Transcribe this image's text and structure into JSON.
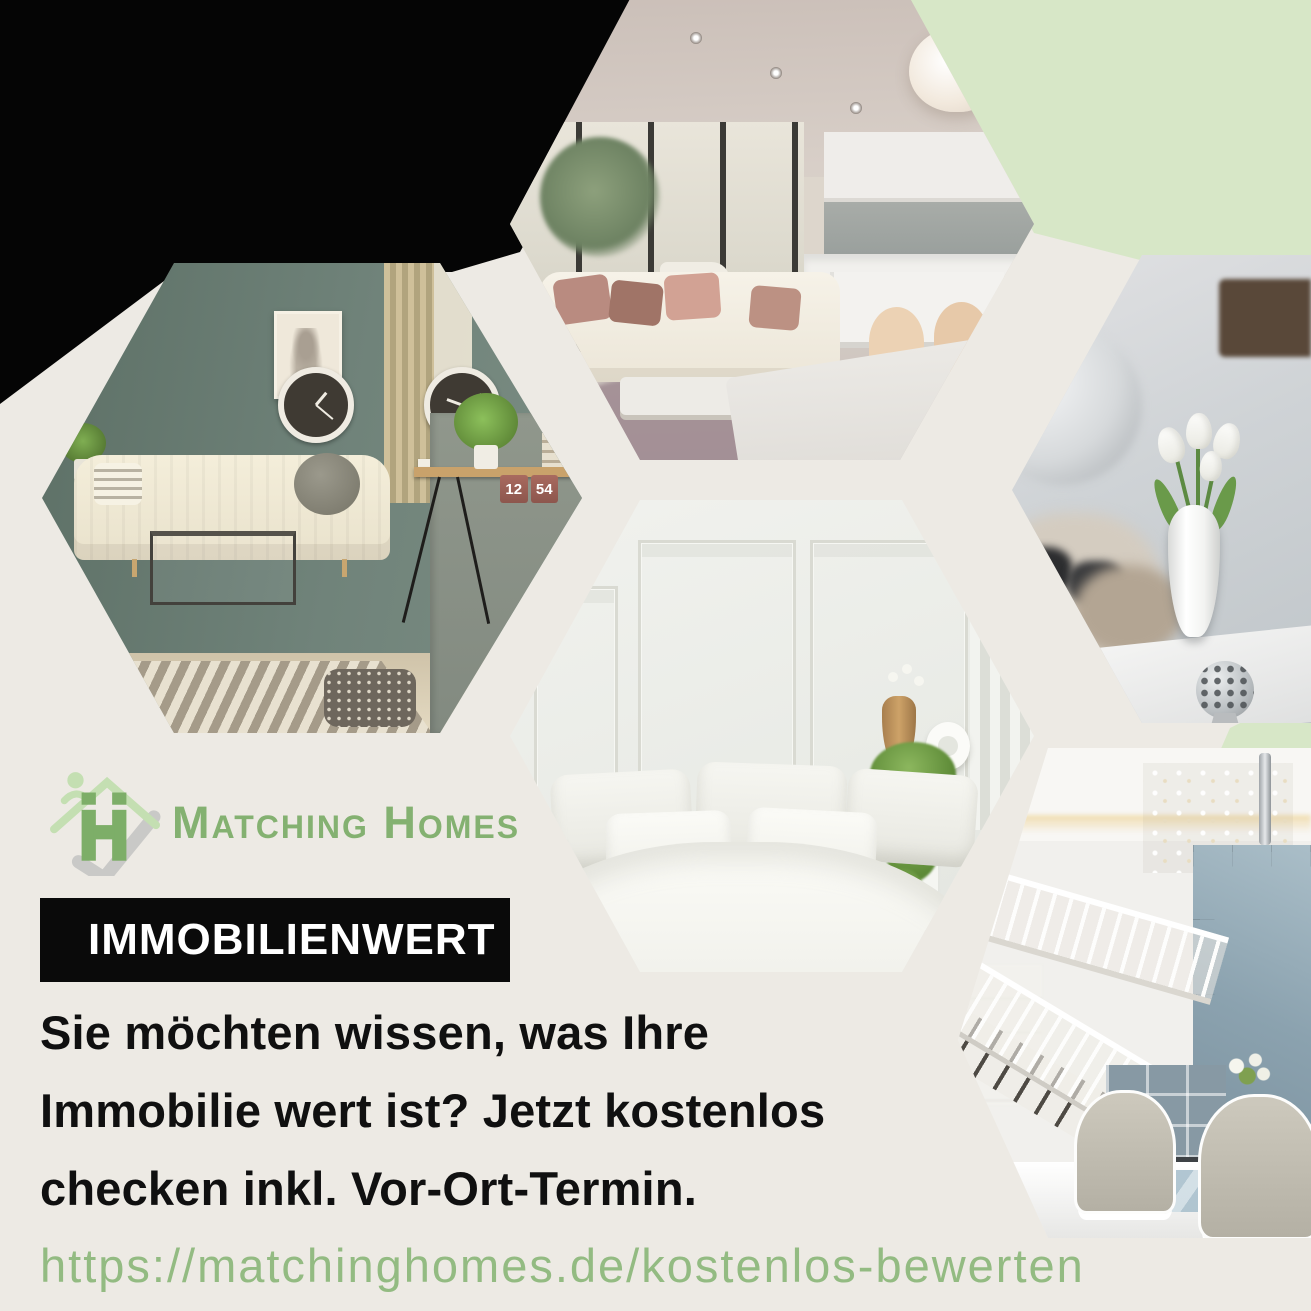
{
  "canvas": {
    "width": 1311,
    "height": 1311
  },
  "palette": {
    "background_cream": "#edeae4",
    "corner_black": "#050505",
    "mint_green": "#d7e7c7",
    "brand_green": "#84b171",
    "url_green": "#93bb82",
    "badge_bg": "#0a0a0a",
    "badge_text": "#ffffff",
    "headline_text": "#101010"
  },
  "logo": {
    "brand": "Matching Homes",
    "icon": "house-with-person-and-check-icon"
  },
  "badge": {
    "label": "IMMOBILIENWERT"
  },
  "headline": {
    "lines": [
      "Sie möchten wissen, was Ihre",
      "Immobilie wert ist? Jetzt kostenlos",
      "checken inkl. Vor-Ort-Termin."
    ]
  },
  "link": {
    "url": "https://matchinghomes.de/kostenlos-bewerten"
  },
  "collage": {
    "photos": [
      {
        "id": "living-kitchen",
        "description": "Modern open-plan living room with white corner sofa, dusty-pink pillows, dining table and white kitchen"
      },
      {
        "id": "green-living-room",
        "description": "Living room with sage green wall, cream sofa, two wall clocks and a wooden desk",
        "clock_left_label": "LONDON",
        "clock_right_label": "TOKYO",
        "flip_clock_hours": "12",
        "flip_clock_minutes": "54"
      },
      {
        "id": "white-tulips",
        "description": "White tulips in a white vase on a table in a bright living room"
      },
      {
        "id": "bright-bedroom",
        "description": "Bright bedroom with white bedding, panelled wall and hanging plant"
      },
      {
        "id": "staircase-lounge",
        "description": "Elegant white staircase with lounge chairs and blue-grey panelled wall"
      }
    ]
  }
}
